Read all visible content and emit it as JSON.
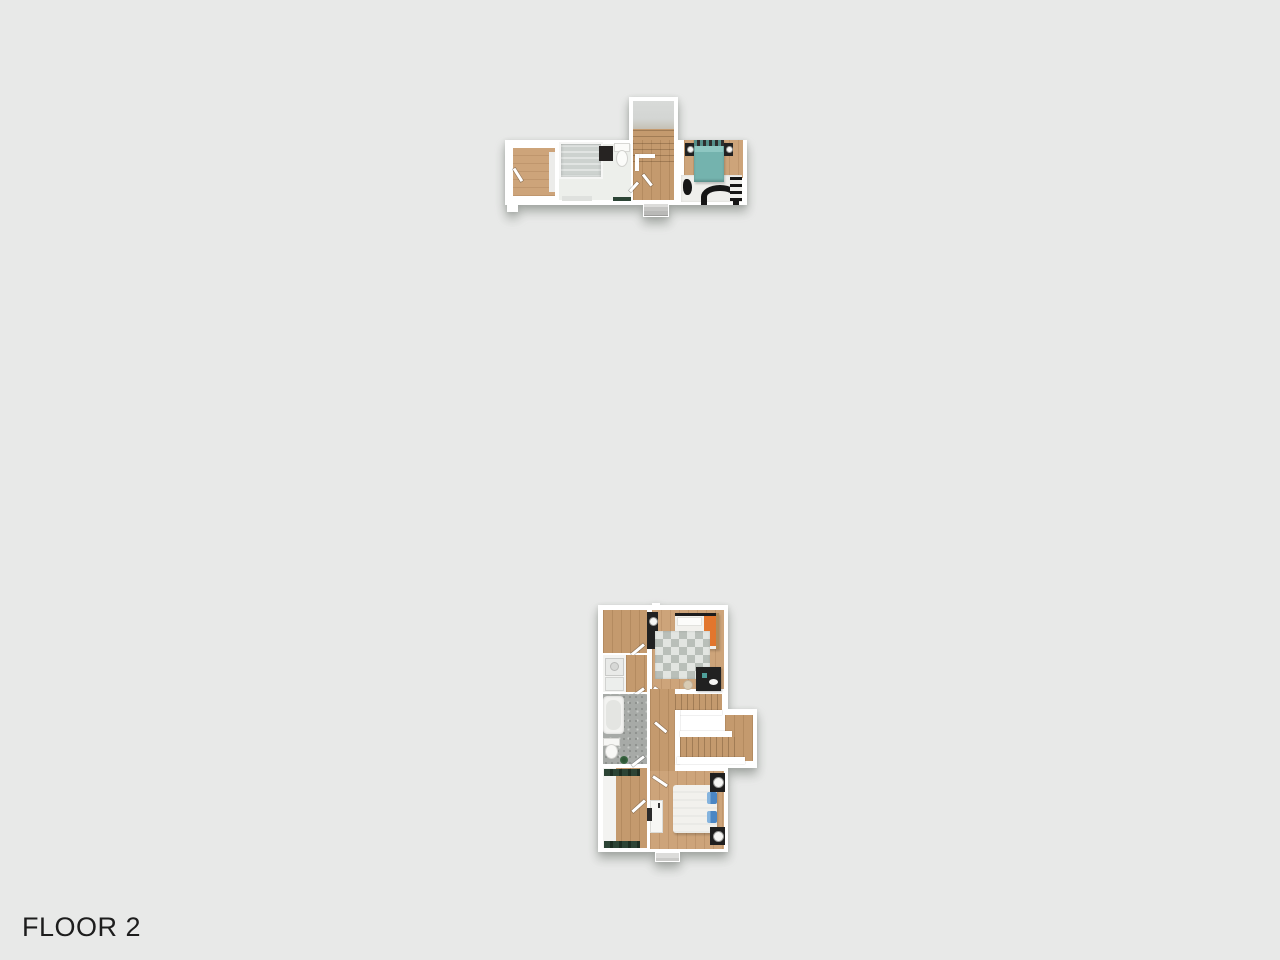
{
  "title": "FLOOR 2",
  "colors": {
    "background": "#e8e9e8",
    "wall": "#ffffff",
    "wood_light": "#cda47a",
    "wood_mid": "#c49a6e",
    "tower_gray": "#d3d5d3",
    "tub_gray": "#cdd2cf",
    "floor_white": "#edefeb",
    "speckle": "#a7aaa7",
    "checker_dark": "#b9bfb9",
    "checker_light": "#e2e5e1",
    "teal": "#74b3ae",
    "teal_dark": "#548f8a",
    "orange": "#e2762d",
    "blue": "#4a86c4",
    "blue_light": "#85b4de",
    "dark": "#212121",
    "green_dark": "#2c4435",
    "rug_white": "#efefec",
    "rug_black": "#161616",
    "step_gray": "#dcdcda",
    "label": "#1d1d1d"
  }
}
